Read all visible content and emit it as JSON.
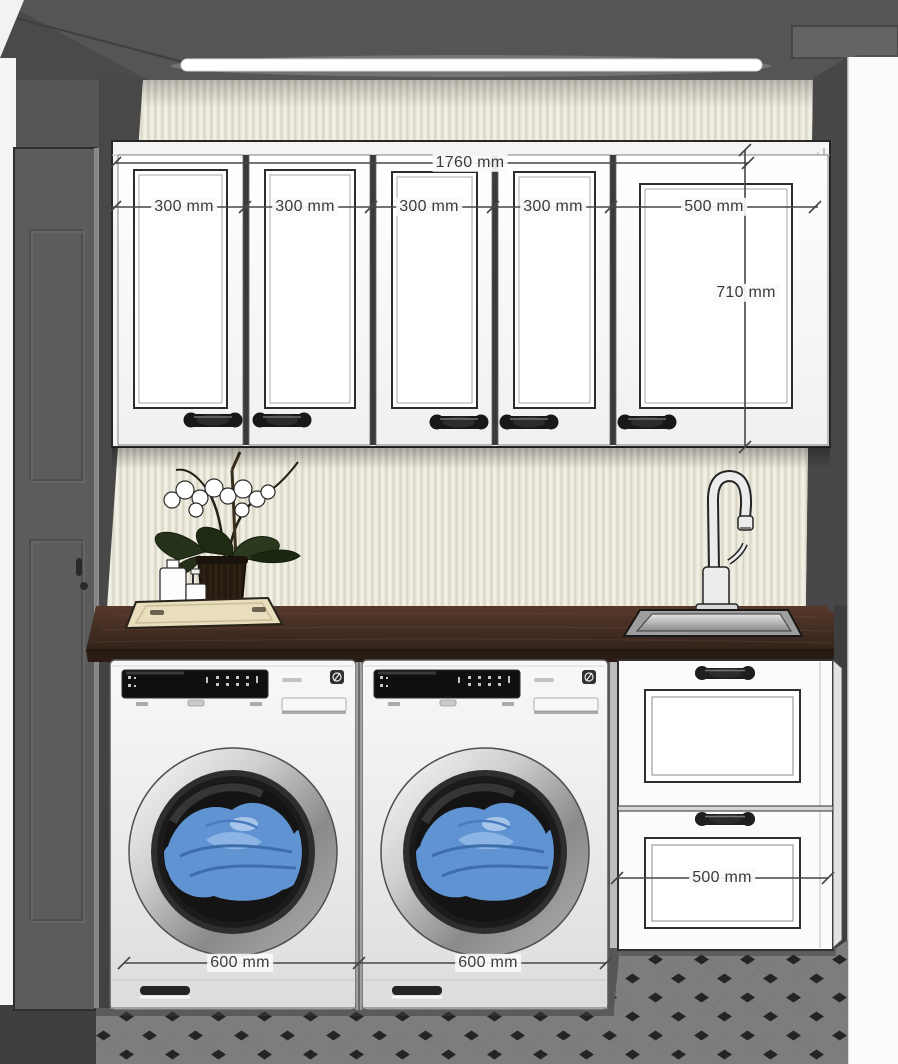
{
  "meta": {
    "type": "3d-interior-design-render",
    "room": "laundry room elevation with dimensions",
    "units": "mm"
  },
  "dimension_labels": {
    "wall_cabinets_total_width": "1760 mm",
    "door_1_width": "300 mm",
    "door_2_width": "300 mm",
    "door_3_width": "300 mm",
    "door_4_width": "300 mm",
    "door_5_width": "500 mm",
    "wall_cabinet_height": "710 mm",
    "washer_1_width": "600 mm",
    "washer_2_width": "600 mm",
    "base_drawer_width": "500 mm"
  },
  "scene_objects": [
    "dark ceiling with LED strip light",
    "cream fluted wall panel backsplash",
    "white five-door wall cabinet with dark bar pulls",
    "dark wood countertop",
    "stainless undermount sink with gooseneck faucet",
    "tray with orchid plant and white bottles",
    "two front-load washing machines with blue laundry in drums",
    "white base cabinet with two drawers",
    "gray octagon-and-dot tile floor",
    "gray interior door on the left",
    "bright doorway opening on the right"
  ],
  "colors": {
    "ceiling": "#575757",
    "side_wall": "#4a4a4a",
    "fluted_panel": "#ebe8dc",
    "cabinet_white": "#fbfbfb",
    "countertop_wood": "#3c2a21",
    "laundry_blue": "#5f93d2",
    "floor_tile": "#7d7d7d",
    "tile_dot": "#242424",
    "dimension_text": "#3b3b3b",
    "led_light": "#ffffff"
  }
}
